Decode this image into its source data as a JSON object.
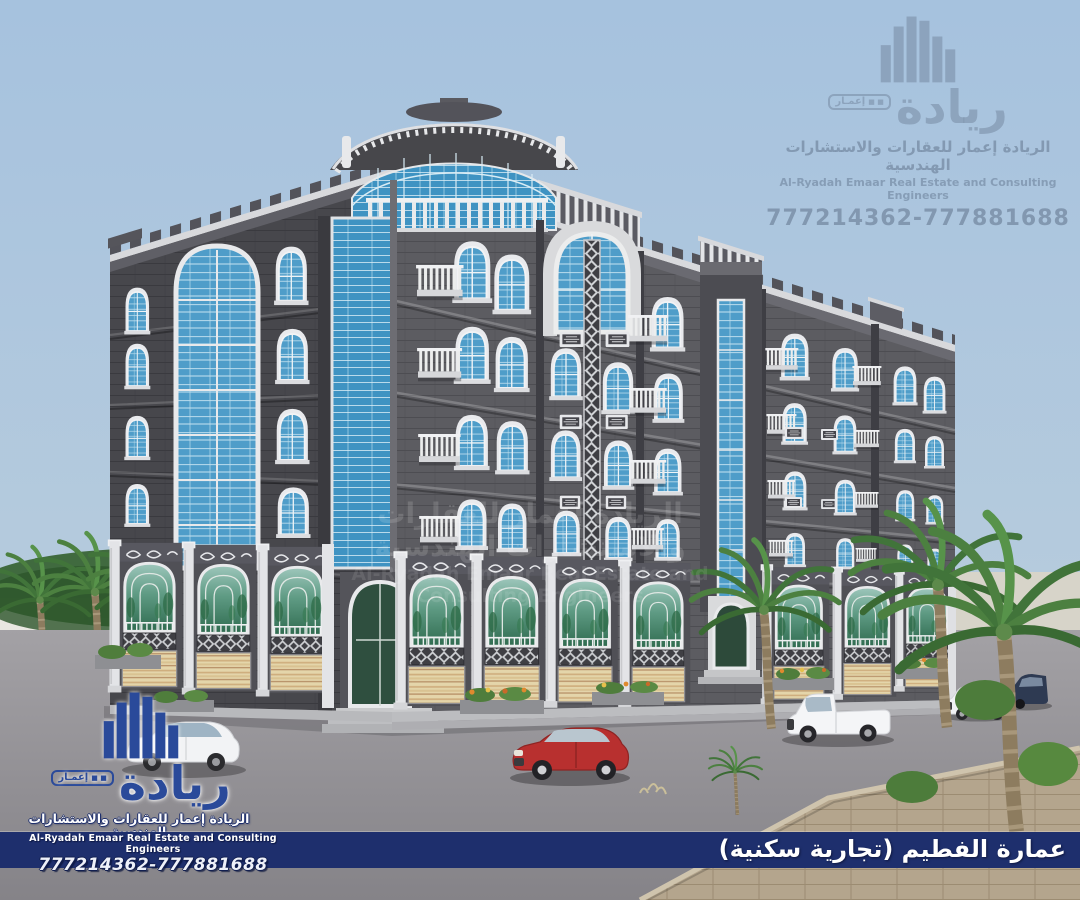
{
  "brand": {
    "logo_calligraphy_ar": "ريادة",
    "logo_tag_ar": "إعمـار",
    "logo_tag_squares": "■ ■",
    "name_ar": "الريادة إعمار للعقارات والاستشارات الهندسية",
    "name_en": "Al-Ryadah Emaar Real Estate and Consulting Engineers",
    "phones": "777214362-777881688"
  },
  "caption": {
    "title_ar": "عمارة الفطيم (تجارية سكنية)"
  },
  "colors": {
    "sky_top": "#a6c2de",
    "sky_bottom": "#c6d5de",
    "navy_band": "#1e2f6d",
    "logo_blue": "#2a4a9a",
    "facade_dark": "#47474c",
    "facade_light": "#5c5c61",
    "glass_blue": "#4f9dc9",
    "glass_green": "#5f9b84",
    "shutter_cream": "#e4d5aa",
    "shutter_tan": "#c9a97a",
    "trim_white": "#eceded",
    "road_gray": "#97969a",
    "sidewalk_tan": "#b4a58d",
    "palm_green": "#4c8040",
    "car_red": "#b8302f"
  }
}
